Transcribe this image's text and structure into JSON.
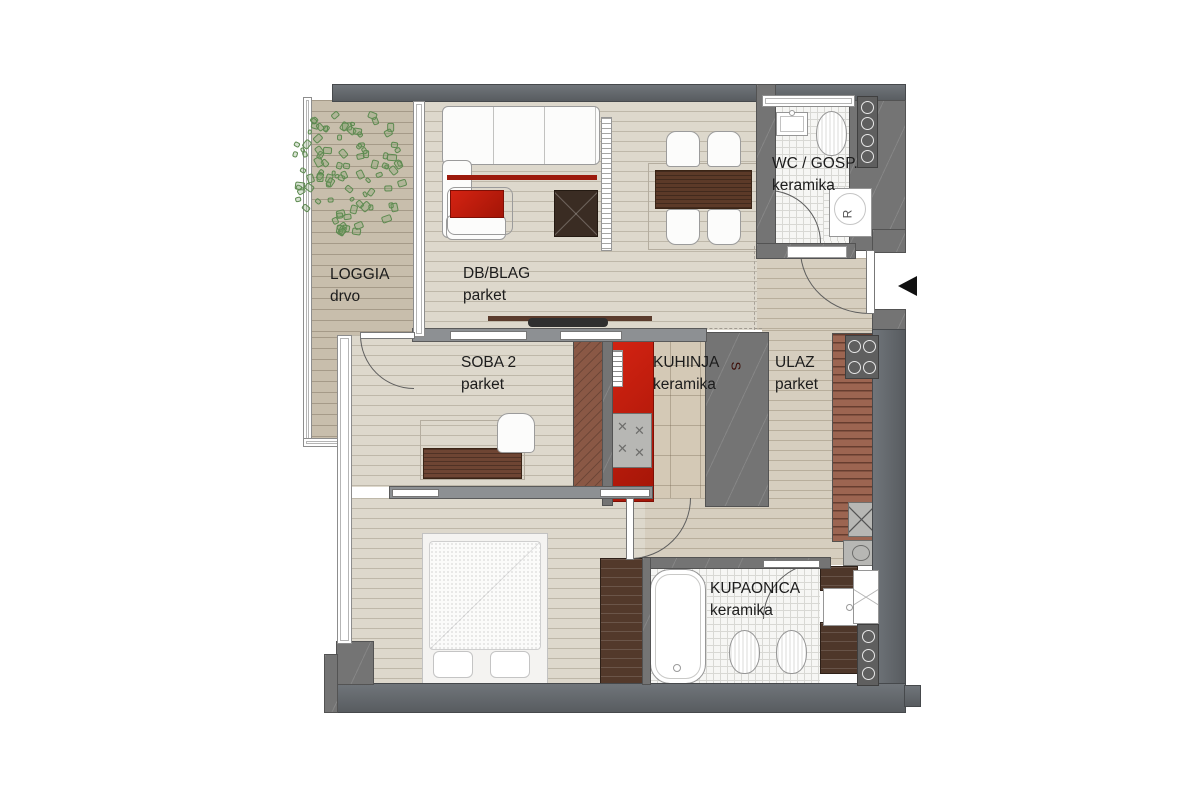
{
  "title": "Apartment floor plan",
  "rooms": [
    {
      "id": "loggia",
      "name": "LOGGIA",
      "floor": "drvo"
    },
    {
      "id": "db-blag",
      "name": "DB/BLAG",
      "floor": "parket"
    },
    {
      "id": "wc-gosp",
      "name": "WC / GOSP.",
      "floor": "keramika"
    },
    {
      "id": "soba-2",
      "name": "SOBA 2",
      "floor": "parket"
    },
    {
      "id": "kuhinja",
      "name": "KUHINJA",
      "floor": "keramika"
    },
    {
      "id": "ulaz",
      "name": "ULAZ",
      "floor": "parket"
    },
    {
      "id": "kupaonica",
      "name": "KUPAONICA",
      "floor": "keramika"
    }
  ],
  "markers": {
    "washer": "R",
    "kitchen_unit": "S"
  },
  "colors": {
    "wall": "#747474",
    "accent_red": "#cf1910",
    "loggia_wood": "#c8beac",
    "parquet": "#ddd8cc",
    "tile_beige": "#d4c9b6",
    "wardrobe_brown": "#9c6551",
    "dark_furniture": "#4e372a",
    "tree_green": "#6f9a63"
  }
}
